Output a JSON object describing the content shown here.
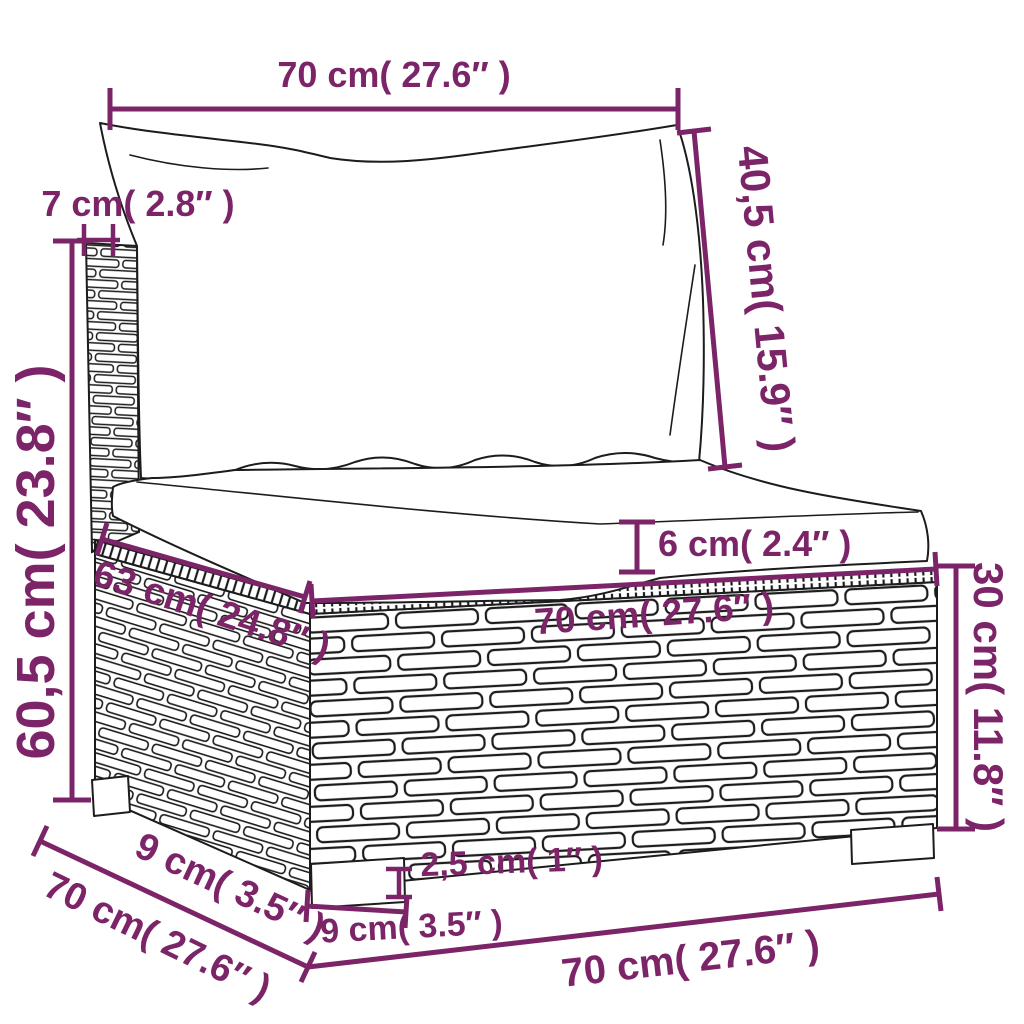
{
  "colors": {
    "background": "#ffffff",
    "line_art": "#1c1c1c",
    "dimension_accent": "#7c2468"
  },
  "diagram": {
    "type": "furniture-dimension-diagram",
    "subject": "poly rattan sofa section with back and seat cushions"
  },
  "labels": {
    "back_cushion_width": "70 cm( 27.6″ )",
    "back_panel_thickness": "7 cm( 2.8″ )",
    "total_height": "60,5 cm( 23.8″ )",
    "back_cushion_height": "40,5 cm( 15.9″ )",
    "seat_cushion_thickness": "6 cm( 2.4″ )",
    "seat_depth": "63 cm( 24.8″ )",
    "seat_width": "70 cm( 27.6″ )",
    "base_height": "30 cm( 11.8″ )",
    "leg_height": "2,5 cm( 1″ )",
    "front_leg_width": "9 cm( 3.5″ )",
    "side_leg_depth": "9 cm( 3.5″ )",
    "side_depth": "70 cm( 27.6″ )",
    "base_width": "70 cm( 27.6″ )"
  }
}
